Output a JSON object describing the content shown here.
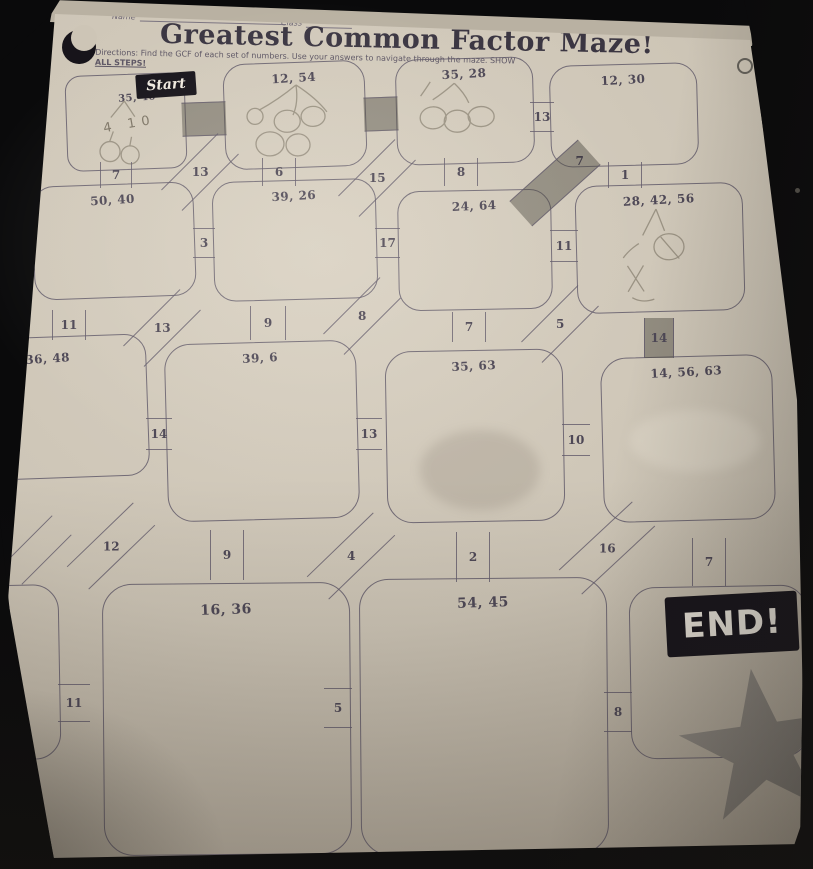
{
  "header": {
    "name_label": "Name",
    "class_label": "Class",
    "date_label": "Date",
    "title": "Greatest Common Factor Maze!",
    "directions_line1": "Directions: Find the GCF of each set of numbers. Use your answers to navigate through the maze. SHOW",
    "directions_line2": "ALL STEPS!"
  },
  "maze": {
    "start_label": "Start",
    "end_label": "END!",
    "nodes": [
      {
        "id": "start",
        "pair": "35, 40"
      },
      {
        "id": "n1",
        "pair": "12, 54"
      },
      {
        "id": "n2",
        "pair": "35, 28"
      },
      {
        "id": "n3",
        "pair": "12, 30"
      },
      {
        "id": "n4",
        "pair": "50, 40"
      },
      {
        "id": "n5",
        "pair": "39, 26"
      },
      {
        "id": "n6",
        "pair": "24, 64"
      },
      {
        "id": "n7",
        "pair": "28, 42, 56"
      },
      {
        "id": "n8",
        "pair": "36, 48"
      },
      {
        "id": "n9",
        "pair": "39, 6"
      },
      {
        "id": "n10",
        "pair": "35, 63"
      },
      {
        "id": "n11",
        "pair": "14, 56, 63"
      },
      {
        "id": "n12",
        "pair": ""
      },
      {
        "id": "n13",
        "pair": "16, 36"
      },
      {
        "id": "n14",
        "pair": "54, 45"
      },
      {
        "id": "end",
        "pair": ""
      }
    ],
    "connectors": [
      {
        "value": "",
        "shaded": true,
        "between": "start/12,54"
      },
      {
        "value": "",
        "shaded": true,
        "between": "12,54/35,28"
      },
      {
        "value": "13",
        "shaded": false,
        "between": "35,28/12,30"
      },
      {
        "value": "7",
        "shaded": false,
        "between": "start/50,40"
      },
      {
        "value": "13",
        "shaded": false,
        "between": "start/39,26"
      },
      {
        "value": "6",
        "shaded": false,
        "between": "12,54/39,26"
      },
      {
        "value": "15",
        "shaded": false,
        "between": "12,54/24,64"
      },
      {
        "value": "8",
        "shaded": false,
        "between": "35,28/24,64"
      },
      {
        "value": "7",
        "shaded": true,
        "between": "35,28/28,42,56"
      },
      {
        "value": "1",
        "shaded": false,
        "between": "12,30/28,42,56"
      },
      {
        "value": "3",
        "shaded": false,
        "between": "50,40/39,26"
      },
      {
        "value": "17",
        "shaded": false,
        "between": "39,26/24,64"
      },
      {
        "value": "11",
        "shaded": false,
        "between": "24,64/28,42,56"
      },
      {
        "value": "11",
        "shaded": false,
        "between": "50,40/36,48"
      },
      {
        "value": "13",
        "shaded": false,
        "between": "50,40/39,6"
      },
      {
        "value": "9",
        "shaded": false,
        "between": "39,26/39,6"
      },
      {
        "value": "8",
        "shaded": false,
        "between": "39,26/35,63"
      },
      {
        "value": "7",
        "shaded": false,
        "between": "24,64/35,63"
      },
      {
        "value": "5",
        "shaded": false,
        "between": "24,64/14,56,63"
      },
      {
        "value": "14",
        "shaded": true,
        "between": "28,42,56/14,56,63"
      },
      {
        "value": "14",
        "shaded": false,
        "between": "36,48/39,6"
      },
      {
        "value": "13",
        "shaded": false,
        "between": "39,6/35,63"
      },
      {
        "value": "10",
        "shaded": false,
        "between": "35,63/14,56,63"
      },
      {
        "value": "",
        "shaded": false,
        "between": "36,48/left-box"
      },
      {
        "value": "12",
        "shaded": false,
        "between": "36,48/16,36"
      },
      {
        "value": "9",
        "shaded": false,
        "between": "39,6/16,36"
      },
      {
        "value": "4",
        "shaded": false,
        "between": "39,6/54,45"
      },
      {
        "value": "2",
        "shaded": false,
        "between": "35,63/54,45"
      },
      {
        "value": "16",
        "shaded": false,
        "between": "35,63/end"
      },
      {
        "value": "7",
        "shaded": false,
        "between": "14,56,63/end"
      },
      {
        "value": "11",
        "shaded": false,
        "between": "left-box/16,36"
      },
      {
        "value": "5",
        "shaded": false,
        "between": "16,36/54,45"
      },
      {
        "value": "8",
        "shaded": false,
        "between": "54,45/end"
      }
    ],
    "pencil": {
      "start_work": "4 10"
    }
  },
  "colors": {
    "paper": "#cdc5b6",
    "ink": "#4e4856",
    "badge_bg": "#16131a",
    "badge_text": "#efeae0",
    "pencil": "#847c6d",
    "star": "#8a857c",
    "background": "#0a0a0b"
  }
}
